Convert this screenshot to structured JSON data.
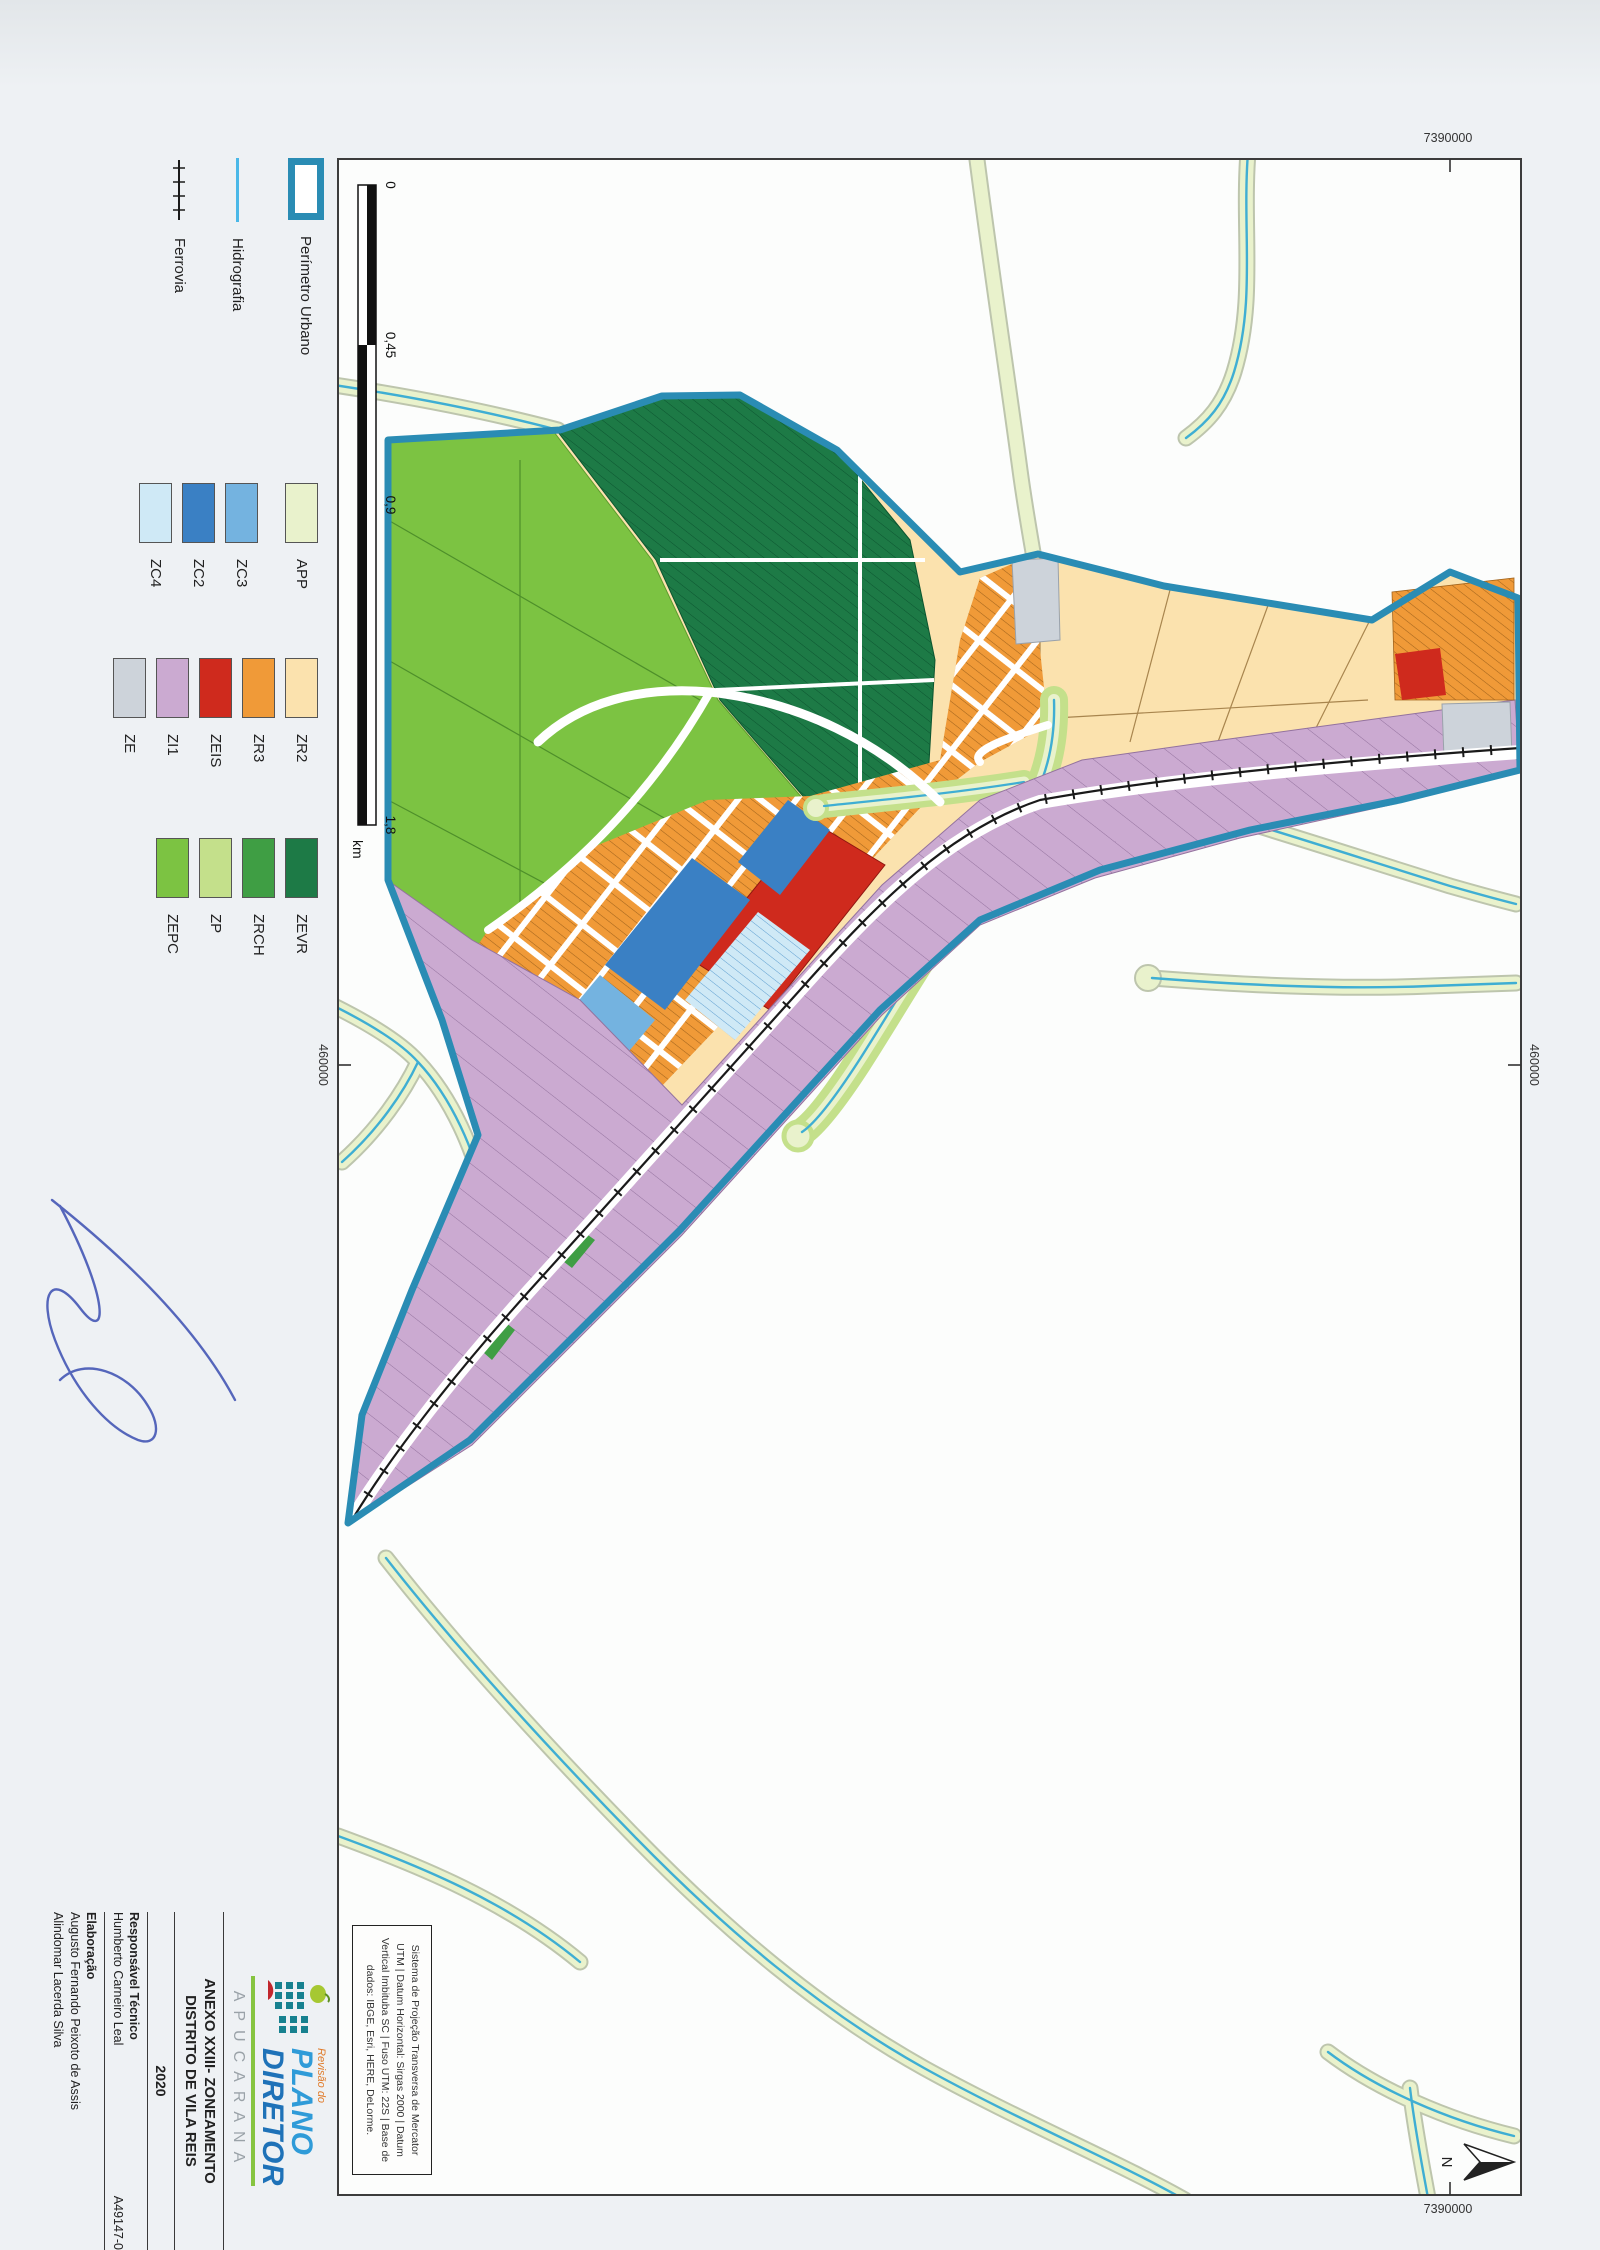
{
  "legend": {
    "items": [
      {
        "label": "Perímetro Urbano",
        "color": "#2a8cb4"
      },
      {
        "label": "Hidrografia",
        "color": "#4ab8e8"
      },
      {
        "label": "Ferrovia",
        "color": "#1a1a1a"
      }
    ],
    "zones": [
      {
        "code": "APP",
        "color": "#e9f2cc"
      },
      {
        "code": "ZC3",
        "color": "#74b3e0"
      },
      {
        "code": "ZC2",
        "color": "#3a80c4"
      },
      {
        "code": "ZC4",
        "color": "#cfe9f6"
      },
      {
        "code": "ZR2",
        "color": "#fbe2ae"
      },
      {
        "code": "ZR3",
        "color": "#f09a38"
      },
      {
        "code": "ZEIS",
        "color": "#cf2a1d"
      },
      {
        "code": "ZI1",
        "color": "#cbaad1"
      },
      {
        "code": "ZE",
        "color": "#cdd3da"
      },
      {
        "code": "ZEVR",
        "color": "#1d7a46"
      },
      {
        "code": "ZRCH",
        "color": "#3f9e44"
      },
      {
        "code": "ZP",
        "color": "#c4e08b"
      },
      {
        "code": "ZEPC",
        "color": "#7cc342"
      }
    ]
  },
  "scalebar": {
    "k0": "0",
    "k1": "0,45",
    "k2": "0,9",
    "k3": "1,8",
    "unit": "km"
  },
  "grid": {
    "northing": "7390000",
    "easting": "460000"
  },
  "north": {
    "label": "N"
  },
  "projection": {
    "l1": "Sistema de Projeção Transversa de Mercator",
    "l2": "UTM | Datum Horizontal: Sirgas 2000 | Datum",
    "l3": "Vertical Imbituba SC | Fuso UTM: 22S | Base de",
    "l4": "dados: IBGE, Esri, HERE, DeLorme."
  },
  "title_block": {
    "logo_small": "Revisão do",
    "logo_l1": "PLANO",
    "logo_l2": "DIRETOR",
    "city": "APUCARANA",
    "annex1": "ANEXO XXIII- ZONEAMENTO",
    "annex2": "DISTRITO DE VILA REIS",
    "year": "2020",
    "resp_label": "Responsável Técnico",
    "resp_name": "Humberto Carneiro Leal",
    "code": "A49147-0",
    "elab_label": "Elaboração",
    "elab_name1": "Augusto Fernando Peixoto de Assis",
    "elab_name2": "Alindomar Lacerda Silva"
  }
}
